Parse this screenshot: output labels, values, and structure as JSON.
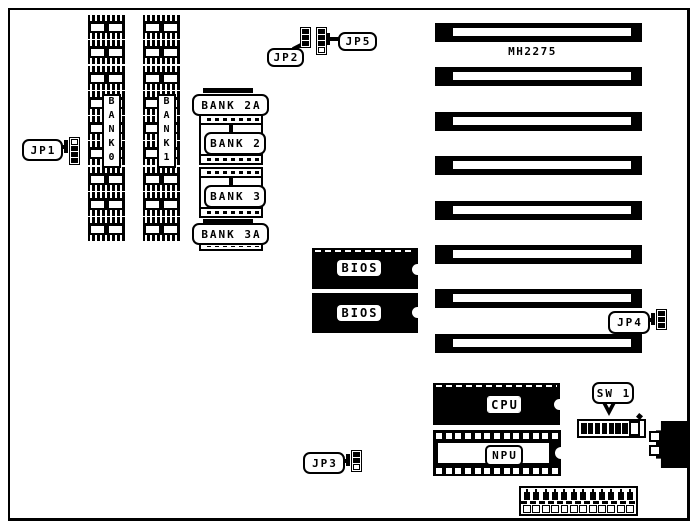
{
  "board": {
    "model": "MH2275",
    "ink_color": "#000000",
    "paper_color": "#ffffff"
  },
  "labels": {
    "jp1": "JP1",
    "jp2": "JP2",
    "jp3": "JP3",
    "jp4": "JP4",
    "jp5": "JP5",
    "sw1": "SW 1",
    "bank0": "BANK0",
    "bank1": "BANK1",
    "bank2a": "BANK 2A",
    "bank2": "BANK 2",
    "bank3": "BANK 3",
    "bank3a": "BANK 3A",
    "bios1": "BIOS",
    "bios2": "BIOS",
    "cpu": "CPU",
    "npu": "NPU"
  },
  "jumpers": {
    "jp1": {
      "cells": [
        "open",
        "closed",
        "closed",
        "closed"
      ]
    },
    "jp2": {
      "cells": [
        "closed",
        "closed",
        "closed"
      ]
    },
    "jp3": {
      "cells": [
        "closed",
        "closed",
        "open"
      ]
    },
    "jp4": {
      "cells": [
        "closed",
        "closed",
        "closed"
      ]
    },
    "jp5": {
      "cells": [
        "closed",
        "closed",
        "closed",
        "open"
      ]
    }
  },
  "sw1_switch": {
    "states": [
      "on",
      "on",
      "on",
      "on",
      "on",
      "on",
      "on",
      "off"
    ]
  },
  "decor": {
    "memory_chips_per_column": 9,
    "expansion_slots": 8,
    "npu_pins_per_row": 13,
    "bottom_connector_pins": 12,
    "bottom_connector_cells": 12
  }
}
